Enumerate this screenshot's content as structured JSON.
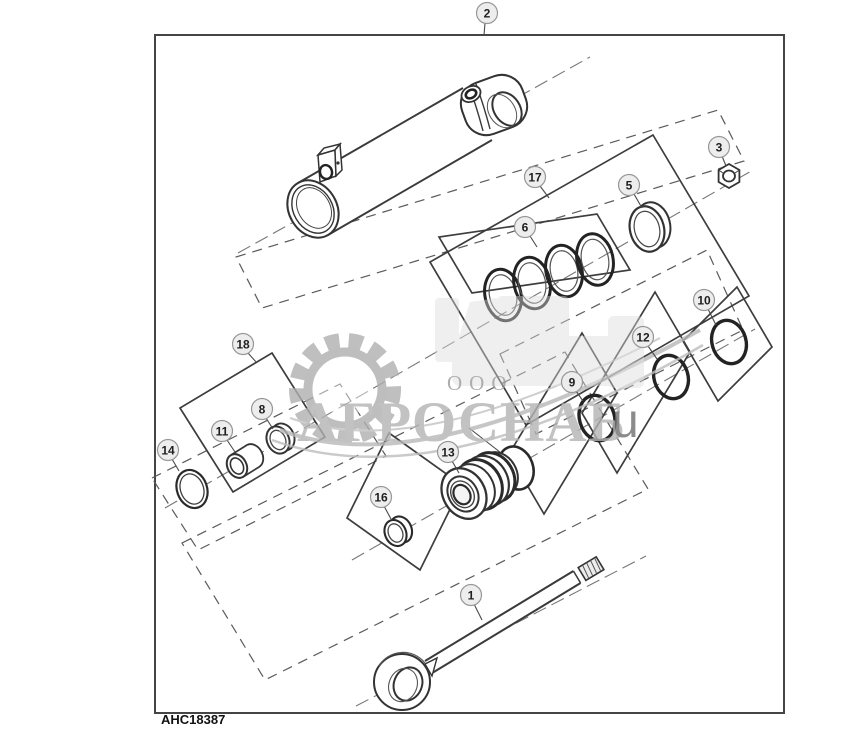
{
  "figure": {
    "code": "AHC18387"
  },
  "watermark": {
    "prefix": "ООО",
    "name": "АГРОСНАБ",
    "letter": "u"
  },
  "callouts": {
    "c1": "1",
    "c2": "2",
    "c3": "3",
    "c5": "5",
    "c6": "6",
    "c8": "8",
    "c9": "9",
    "c10": "10",
    "c11": "11",
    "c12": "12",
    "c13": "13",
    "c14": "14",
    "c16": "16",
    "c17": "17",
    "c18": "18"
  },
  "colors": {
    "line": "#3a3a3a",
    "dash": "#5a5a5a",
    "callout_fill": "#ededed",
    "watermark_gray": "#b4b4b4",
    "background": "#ffffff"
  }
}
